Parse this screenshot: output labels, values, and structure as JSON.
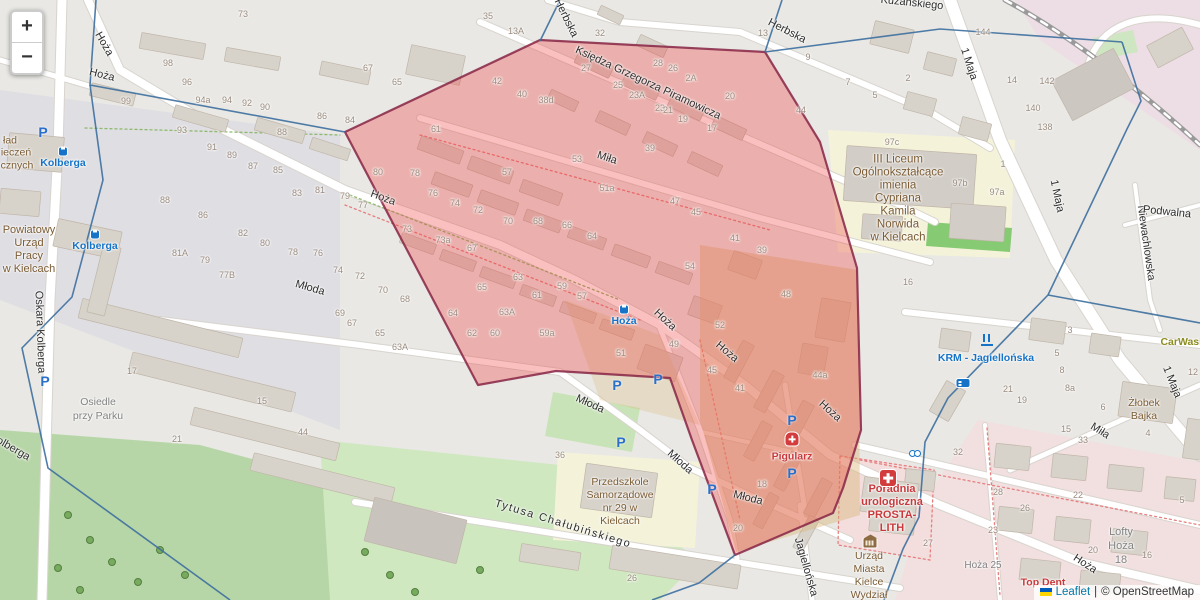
{
  "controls": {
    "zoom_in": "+",
    "zoom_out": "−"
  },
  "attribution": {
    "leaflet": "Leaflet",
    "separator": "|",
    "osm": "© OpenStreetMap"
  },
  "colors": {
    "highlight_fill": "#ef3b3b",
    "highlight_border": "#872445",
    "cell_line": "#3d6f9e",
    "link_blue": "#0078a8",
    "transit_blue": "#1673c7",
    "poi_brown": "#7a5b33",
    "health_red": "#c9393c",
    "park_green": "#b7d6a7",
    "school_yellow": "#f4f3da"
  },
  "labels": {
    "streets": [
      {
        "t": "Hoża",
        "x": 104,
        "y": 44,
        "r": 60
      },
      {
        "t": "Hoża",
        "x": 102,
        "y": 75,
        "r": 14
      },
      {
        "t": "Hoża",
        "x": 383,
        "y": 198,
        "r": 20
      },
      {
        "t": "Hoża",
        "x": 665,
        "y": 320,
        "r": 43
      },
      {
        "t": "Hoża",
        "x": 727,
        "y": 352,
        "r": 40
      },
      {
        "t": "Hoża",
        "x": 830,
        "y": 411,
        "r": 42
      },
      {
        "t": "Hoża",
        "x": 1085,
        "y": 564,
        "r": 33
      },
      {
        "t": "Miła",
        "x": 607,
        "y": 158,
        "r": 18
      },
      {
        "t": "Miła",
        "x": 1100,
        "y": 431,
        "r": 32
      },
      {
        "t": "Młoda",
        "x": 310,
        "y": 288,
        "r": 16
      },
      {
        "t": "Młoda",
        "x": 590,
        "y": 404,
        "r": 24
      },
      {
        "t": "Młoda",
        "x": 680,
        "y": 462,
        "r": 42
      },
      {
        "t": "Młoda",
        "x": 748,
        "y": 498,
        "r": 14
      },
      {
        "t": "Księdza Grzegorza Piramowicza",
        "x": 648,
        "y": 83,
        "r": 25
      },
      {
        "t": "Herbska",
        "x": 566,
        "y": 18,
        "r": 64
      },
      {
        "t": "Herbska",
        "x": 787,
        "y": 31,
        "r": 27
      },
      {
        "t": "1 Maja",
        "x": 969,
        "y": 64,
        "r": 72
      },
      {
        "t": "1 Maja",
        "x": 1057,
        "y": 196,
        "r": 78
      },
      {
        "t": "1 Maja",
        "x": 1172,
        "y": 382,
        "r": 68
      },
      {
        "t": "Oskara Kolberga",
        "x": 40,
        "y": 332,
        "r": 88
      },
      {
        "t": "Kolberga",
        "x": 10,
        "y": 447,
        "r": 30
      },
      {
        "t": "Tytusa Chałubińskiego",
        "x": 563,
        "y": 524,
        "r": 17,
        "ls": 1.5
      },
      {
        "t": "Jagiellońska",
        "x": 806,
        "y": 567,
        "r": 74
      },
      {
        "t": "Niewachlowska",
        "x": 1146,
        "y": 243,
        "r": 82
      },
      {
        "t": "Podwalna",
        "x": 1167,
        "y": 212,
        "r": 6
      },
      {
        "t": "Kuzańskiego",
        "x": 912,
        "y": 3,
        "r": 6
      }
    ],
    "pois": [
      {
        "lines": [
          "III Liceum",
          "Ogólnokształcące",
          "imienia",
          "Cypriana",
          "Kamila",
          "Norwida",
          "w Kielcach"
        ],
        "x": 898,
        "y": 199,
        "cls": "poi",
        "fs": 11.5
      },
      {
        "lines": [
          "Przedszkole",
          "Samorządowe",
          "nr 29 w",
          "Kielcach"
        ],
        "x": 620,
        "y": 502,
        "cls": "poi",
        "fs": 10.5
      },
      {
        "lines": [
          "Powiatowy",
          "Urząd",
          "Pracy",
          "w Kielcach"
        ],
        "x": 29,
        "y": 250,
        "cls": "poi",
        "fs": 11
      },
      {
        "lines": [
          "Urząd",
          "Miasta",
          "Kielce",
          "Wydział"
        ],
        "x": 869,
        "y": 576,
        "cls": "poi",
        "fs": 10.5
      },
      {
        "lines": [
          "Żłobek",
          "Bajka"
        ],
        "x": 1144,
        "y": 410,
        "cls": "poi",
        "fs": 10.5
      },
      {
        "lines": [
          "ład"
        ],
        "x": 10,
        "y": 141,
        "cls": "poi",
        "fs": 10.5
      },
      {
        "lines": [
          "ieczeń"
        ],
        "x": 16,
        "y": 153,
        "cls": "poi",
        "fs": 10.5
      },
      {
        "lines": [
          "cznych"
        ],
        "x": 17,
        "y": 166,
        "cls": "poi",
        "fs": 10.5
      },
      {
        "lines": [
          "Poradnia",
          "urologiczna",
          "PROSTA-",
          "LITH"
        ],
        "x": 892,
        "y": 509,
        "cls": "med",
        "fs": 11
      },
      {
        "lines": [
          "Pigularz"
        ],
        "x": 792,
        "y": 457,
        "cls": "med",
        "fs": 10.5
      },
      {
        "lines": [
          "Top Dent"
        ],
        "x": 1043,
        "y": 583,
        "cls": "med",
        "fs": 10.5
      },
      {
        "lines": [
          "Osiedle",
          "przy Parku"
        ],
        "x": 98,
        "y": 409,
        "cls": "gray",
        "fs": 10.5
      },
      {
        "lines": [
          "Lofty",
          "Hoża",
          "18"
        ],
        "x": 1121,
        "y": 546,
        "cls": "gray",
        "fs": 11
      },
      {
        "lines": [
          "Hoża 25"
        ],
        "x": 983,
        "y": 566,
        "cls": "gray",
        "fs": 10
      },
      {
        "lines": [
          "CarWash"
        ],
        "x": 1183,
        "y": 342,
        "cls": "olive",
        "fs": 10.5
      }
    ],
    "transit": [
      {
        "t": "Kolberga",
        "x": 63,
        "y": 163
      },
      {
        "t": "Kolberga",
        "x": 95,
        "y": 246
      },
      {
        "t": "Hoża",
        "x": 624,
        "y": 321
      },
      {
        "t": "KRM - Jagiellońska",
        "x": 986,
        "y": 358
      }
    ],
    "numbers": [
      [
        "73",
        243,
        14
      ],
      [
        "98",
        168,
        63
      ],
      [
        "96",
        187,
        82
      ],
      [
        "99",
        126,
        101
      ],
      [
        "94a",
        203,
        100
      ],
      [
        "94",
        227,
        100
      ],
      [
        "92",
        247,
        103
      ],
      [
        "90",
        265,
        107
      ],
      [
        "86",
        322,
        116
      ],
      [
        "84",
        350,
        120
      ],
      [
        "88",
        282,
        132
      ],
      [
        "93",
        182,
        130
      ],
      [
        "91",
        212,
        147
      ],
      [
        "89",
        232,
        155
      ],
      [
        "87",
        253,
        166
      ],
      [
        "85",
        278,
        170
      ],
      [
        "83",
        297,
        193
      ],
      [
        "81",
        320,
        190
      ],
      [
        "79",
        345,
        196
      ],
      [
        "77",
        363,
        205
      ],
      [
        "88",
        165,
        200
      ],
      [
        "86",
        203,
        215
      ],
      [
        "82",
        243,
        233
      ],
      [
        "80",
        265,
        243
      ],
      [
        "78",
        293,
        252
      ],
      [
        "76",
        318,
        253
      ],
      [
        "74",
        338,
        270
      ],
      [
        "81A",
        180,
        253
      ],
      [
        "79",
        205,
        260
      ],
      [
        "77B",
        227,
        275
      ],
      [
        "67",
        368,
        68
      ],
      [
        "65",
        397,
        82
      ],
      [
        "80",
        378,
        172
      ],
      [
        "78",
        415,
        173
      ],
      [
        "76",
        433,
        193
      ],
      [
        "74",
        455,
        203
      ],
      [
        "72",
        478,
        210
      ],
      [
        "70",
        508,
        221
      ],
      [
        "68",
        538,
        221
      ],
      [
        "66",
        567,
        225
      ],
      [
        "64",
        592,
        236
      ],
      [
        "73",
        407,
        229
      ],
      [
        "73a",
        443,
        240
      ],
      [
        "67",
        472,
        248
      ],
      [
        "63",
        518,
        277
      ],
      [
        "65",
        482,
        287
      ],
      [
        "61",
        537,
        295
      ],
      [
        "59",
        562,
        286
      ],
      [
        "57",
        582,
        296
      ],
      [
        "64",
        453,
        313
      ],
      [
        "63A",
        507,
        312
      ],
      [
        "62",
        472,
        333
      ],
      [
        "60",
        495,
        333
      ],
      [
        "59a",
        547,
        333
      ],
      [
        "57",
        507,
        172
      ],
      [
        "53",
        577,
        159
      ],
      [
        "51a",
        607,
        188
      ],
      [
        "72",
        360,
        276
      ],
      [
        "70",
        383,
        290
      ],
      [
        "68",
        405,
        299
      ],
      [
        "69",
        340,
        313
      ],
      [
        "67",
        352,
        323
      ],
      [
        "65",
        380,
        333
      ],
      [
        "63A",
        400,
        347
      ],
      [
        "35",
        488,
        16
      ],
      [
        "13A",
        516,
        31
      ],
      [
        "42",
        497,
        81
      ],
      [
        "40",
        522,
        94
      ],
      [
        "38d",
        546,
        100
      ],
      [
        "61",
        436,
        129
      ],
      [
        "39",
        650,
        148
      ],
      [
        "47",
        675,
        201
      ],
      [
        "45",
        696,
        212
      ],
      [
        "41",
        735,
        238
      ],
      [
        "39",
        762,
        250
      ],
      [
        "54",
        690,
        266
      ],
      [
        "48",
        786,
        294
      ],
      [
        "52",
        720,
        325
      ],
      [
        "44a",
        820,
        375
      ],
      [
        "16",
        908,
        282
      ],
      [
        "32",
        600,
        33
      ],
      [
        "27",
        586,
        68
      ],
      [
        "25",
        618,
        85
      ],
      [
        "23A",
        637,
        95
      ],
      [
        "23",
        660,
        108
      ],
      [
        "21",
        668,
        110
      ],
      [
        "19",
        683,
        119
      ],
      [
        "17",
        712,
        128
      ],
      [
        "28",
        658,
        63
      ],
      [
        "26",
        673,
        68
      ],
      [
        "2A",
        691,
        78
      ],
      [
        "20",
        730,
        96
      ],
      [
        "3",
        1070,
        330
      ],
      [
        "5",
        1057,
        353
      ],
      [
        "8",
        1062,
        370
      ],
      [
        "8a",
        1070,
        388
      ],
      [
        "21",
        1008,
        389
      ],
      [
        "19",
        1022,
        400
      ],
      [
        "32",
        958,
        452
      ],
      [
        "28",
        998,
        492
      ],
      [
        "23",
        993,
        530
      ],
      [
        "27",
        928,
        543
      ],
      [
        "26",
        1025,
        508
      ],
      [
        "22",
        1078,
        495
      ],
      [
        "20",
        1093,
        550
      ],
      [
        "16",
        1147,
        555
      ],
      [
        "5",
        1182,
        500
      ],
      [
        "4",
        1148,
        433
      ],
      [
        "6",
        1103,
        407
      ],
      [
        "15",
        1066,
        429
      ],
      [
        "33",
        1083,
        440
      ],
      [
        "12",
        1193,
        372
      ],
      [
        "142",
        1047,
        81
      ],
      [
        "140",
        1033,
        108
      ],
      [
        "138",
        1045,
        127
      ],
      [
        "144",
        983,
        32
      ],
      [
        "14",
        1012,
        80
      ],
      [
        "44",
        801,
        110
      ],
      [
        "13",
        763,
        33
      ],
      [
        "9",
        808,
        57
      ],
      [
        "7",
        848,
        82
      ],
      [
        "5",
        875,
        95
      ],
      [
        "2",
        908,
        78
      ],
      [
        "97c",
        892,
        142
      ],
      [
        "97b",
        960,
        183
      ],
      [
        "97a",
        997,
        192
      ],
      [
        "1",
        1003,
        164
      ],
      [
        "26",
        632,
        578
      ],
      [
        "18",
        762,
        484
      ],
      [
        "20",
        738,
        528
      ],
      [
        "51",
        621,
        353
      ],
      [
        "49",
        674,
        344
      ],
      [
        "45",
        712,
        370
      ],
      [
        "41",
        740,
        388
      ],
      [
        "15",
        262,
        401
      ],
      [
        "44",
        303,
        432
      ],
      [
        "21",
        177,
        439
      ],
      [
        "17",
        132,
        371
      ],
      [
        "36",
        560,
        455
      ]
    ]
  },
  "icons": [
    {
      "type": "parking",
      "x": 43,
      "y": 133
    },
    {
      "type": "parking",
      "x": 45,
      "y": 382
    },
    {
      "type": "parking",
      "x": 617,
      "y": 386
    },
    {
      "type": "parking",
      "x": 658,
      "y": 380
    },
    {
      "type": "parking",
      "x": 792,
      "y": 421
    },
    {
      "type": "parking",
      "x": 792,
      "y": 474
    },
    {
      "type": "parking",
      "x": 621,
      "y": 443
    },
    {
      "type": "parking",
      "x": 712,
      "y": 490
    },
    {
      "type": "bus-stop",
      "x": 63,
      "y": 150
    },
    {
      "type": "bus-stop",
      "x": 95,
      "y": 233
    },
    {
      "type": "bus-stop",
      "x": 624,
      "y": 308
    },
    {
      "type": "clinic-cross",
      "x": 888,
      "y": 478
    },
    {
      "type": "pharmacy-cross",
      "x": 792,
      "y": 439
    },
    {
      "type": "town-hall",
      "x": 870,
      "y": 543
    },
    {
      "type": "hostel-bed",
      "x": 963,
      "y": 383
    },
    {
      "type": "stroller",
      "x": 915,
      "y": 452
    },
    {
      "type": "bike-station",
      "x": 987,
      "y": 340
    }
  ]
}
